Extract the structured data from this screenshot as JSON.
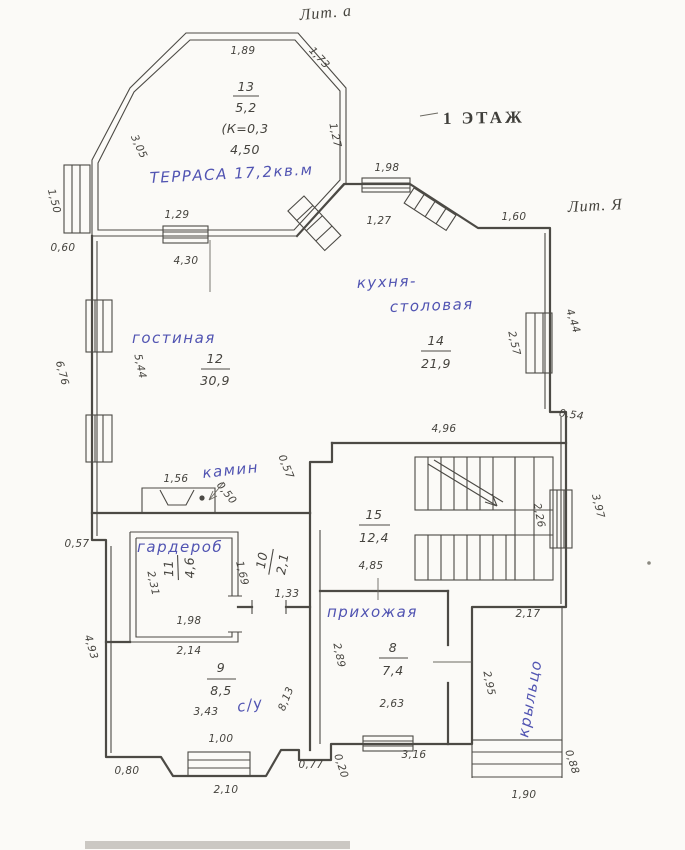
{
  "colors": {
    "ink": "#4c4a45",
    "blue": "#5154b2",
    "paper": "#fbfaf7"
  },
  "header": {
    "litera_top": "Лит. а",
    "floor_stamp": "1 ЭТАЖ",
    "litera_right": "Лит. Я"
  },
  "rooms": {
    "terrace": {
      "label": "ТЕРРАСА 17,2кв.м",
      "number": "13",
      "area": "5,2",
      "coef": "(К=0,3",
      "width": "4,50"
    },
    "living": {
      "label": "гостиная",
      "number": "12",
      "area": "30,9"
    },
    "kitchen": {
      "label1": "кухня-",
      "label2": "столовая",
      "number": "14",
      "area": "21,9"
    },
    "stair": {
      "number": "15",
      "area": "12,4"
    },
    "fireplace": {
      "label": "камин"
    },
    "wardrobe": {
      "label": "гардероб",
      "number": "11",
      "area": "4,6"
    },
    "corridor": {
      "number": "10",
      "area": "2,1"
    },
    "hall": {
      "label": "прихожая",
      "number": "8",
      "area": "7,4"
    },
    "bath": {
      "label": "с/у",
      "number": "9",
      "area": "8,5"
    },
    "porch": {
      "label": "крыльцо"
    }
  },
  "dims": {
    "terrace_top": "1,89",
    "terrace_diag_right": "1,73",
    "terrace_diag_left": "3,05",
    "terrace_right": "1,27",
    "wing_left": "1,50",
    "wing_offset": "0,60",
    "terrace_door": "1,29",
    "living_width": "4,30",
    "kitchen_top_win_out": "1,98",
    "kitchen_top_win_in": "1,27",
    "top_right": "1,60",
    "left_outer": "6,76",
    "living_height": "5,44",
    "kitchen_right_outer": "4,44",
    "kitchen_win_in": "2,57",
    "right_step": "0,54",
    "right_lower_outer": "3,97",
    "stair_win_in": "2,26",
    "stair_width": "4,96",
    "fire_left": "1,56",
    "fire_diag": "0,50",
    "fire_right": "0,57",
    "left_step": "0,57",
    "left_lower": "4,93",
    "bottom_left": "0,80",
    "wardrobe_height": "2,31",
    "wardrobe_width_in": "1,98",
    "wardrobe_width_out": "2,14",
    "corridor_height": "1,69",
    "corridor_door": "1,33",
    "stair_bottom": "4,85",
    "hall_left": "2,89",
    "hall_width_in": "2,63",
    "hall_width_out": "3,16",
    "bath_width": "3,43",
    "bath_win": "1,00",
    "bath_right": "8,13",
    "bay_width": "2,10",
    "step_small": "0,77",
    "step_tiny": "0,20",
    "porch_top": "2,17",
    "porch_left": "2,95",
    "porch_step": "0,88",
    "porch_width": "1,90"
  }
}
